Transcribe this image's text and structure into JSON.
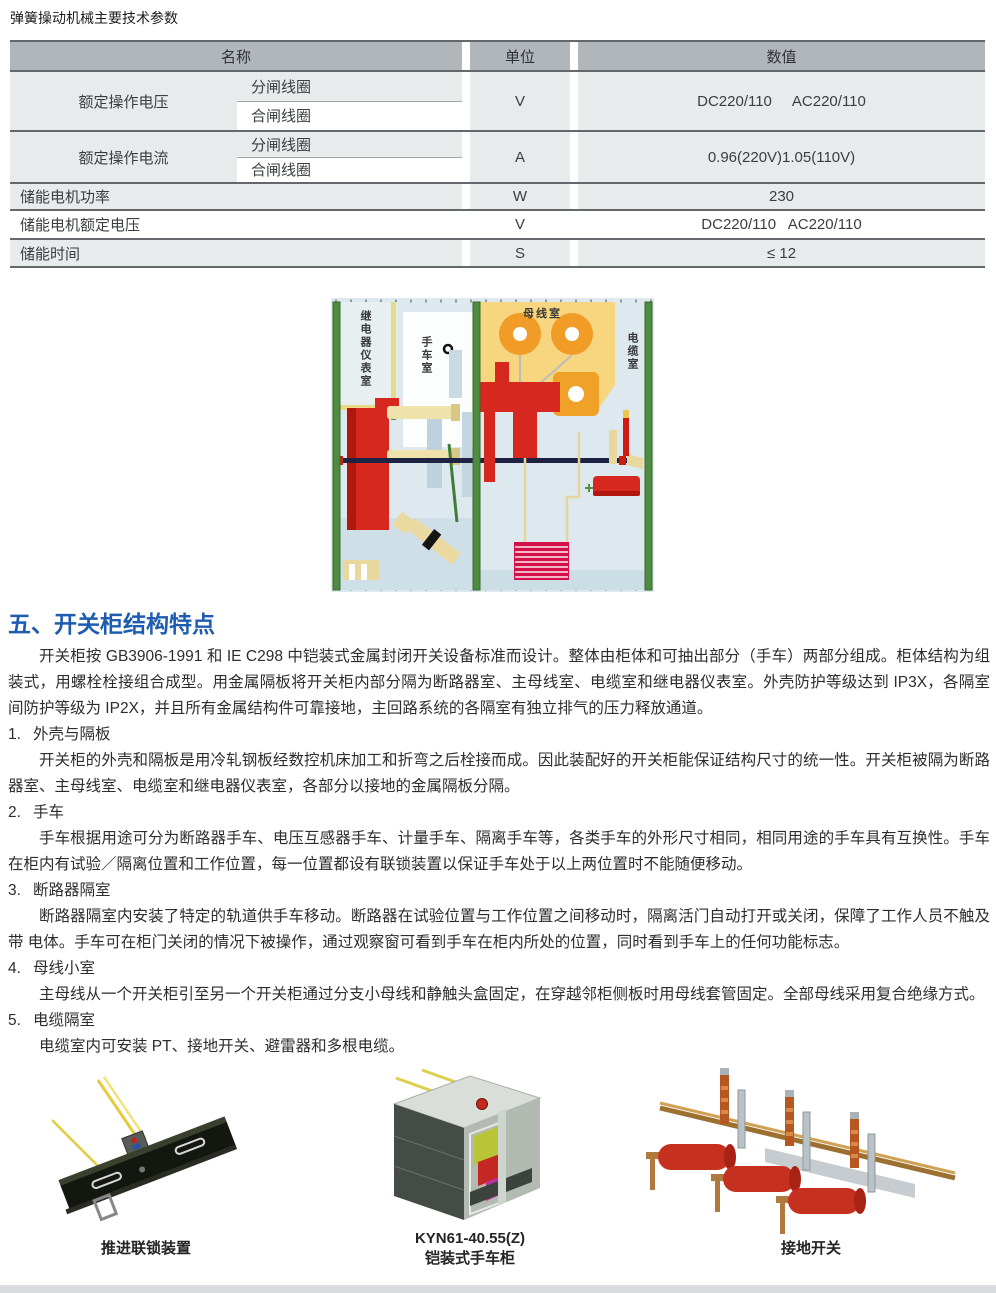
{
  "page": {
    "title": "弹簧操动机械主要技术参数"
  },
  "table": {
    "headers": {
      "name": "名称",
      "unit": "单位",
      "value": "数值"
    },
    "compound_rows": [
      {
        "name": "额定操作电压",
        "sub1": "分闸线圈",
        "sub2": "合闸线圈",
        "unit": "V",
        "value": "DC220/110     AC220/110"
      },
      {
        "name": "额定操作电流",
        "sub1": "分闸线圈",
        "sub2": "合闸线圈",
        "unit": "A",
        "value": "0.96(220V)1.05(110V)"
      }
    ],
    "simple_rows": [
      {
        "name": "储能电机功率",
        "unit": "W",
        "value": "230"
      },
      {
        "name": "储能电机额定电压",
        "unit": "V",
        "value": "DC220/110   AC220/110"
      },
      {
        "name": "储能时间",
        "unit": "S",
        "value": "≤ 12"
      }
    ]
  },
  "diagram": {
    "labels": {
      "relay_room": "继电器仪表室",
      "handcart_room": "手车室",
      "busbar_room": "母线室",
      "cable_room": "电缆室"
    }
  },
  "section": {
    "heading": "五、开关柜结构特点",
    "intro": "开关柜按 GB3906-1991 和 IE C298 中铠装式金属封闭开关设备标准而设计。整体由柜体和可抽出部分（手车）两部分组成。柜体结构为组装式，用螺栓栓接组合成型。用金属隔板将开关柜内部分隔为断路器室、主母线室、电缆室和继电器仪表室。外壳防护等级达到 IP3X，各隔室间防护等级为 IP2X，并且所有金属结构件可靠接地，主回路系统的各隔室有独立排气的压力释放通道。",
    "items": [
      {
        "num": "1.",
        "title": "外壳与隔板",
        "body": "开关柜的外壳和隔板是用冷轧钢板经数控机床加工和折弯之后栓接而成。因此装配好的开关柜能保证结构尺寸的统一性。开关柜被隔为断路 器室、主母线室、电缆室和继电器仪表室，各部分以接地的金属隔板分隔。"
      },
      {
        "num": "2.",
        "title": "手车",
        "body": "手车根据用途可分为断路器手车、电压互感器手车、计量手车、隔离手车等，各类手车的外形尺寸相同，相同用途的手车具有互换性。手车在柜内有试验／隔离位置和工作位置，每一位置都设有联锁装置以保证手车处于以上两位置时不能随便移动。"
      },
      {
        "num": "3.",
        "title": "断路器隔室",
        "body": "断路器隔室内安装了特定的轨道供手车移动。断路器在试验位置与工作位置之间移动时，隔离活门自动打开或关闭，保障了工作人员不触及带 电体。手车可在柜门关闭的情况下被操作，通过观察窗可看到手车在柜内所处的位置，同时看到手车上的任何功能标志。"
      },
      {
        "num": "4.",
        "title": "母线小室",
        "body": "主母线从一个开关柜引至另一个开关柜通过分支小母线和静触头盒固定，在穿越邻柜侧板时用母线套管固定。全部母线采用复合绝缘方式。"
      },
      {
        "num": "5.",
        "title": "电缆隔室",
        "body": "电缆室内可安装 PT、接地开关、避雷器和多根电缆。"
      }
    ]
  },
  "figures": [
    {
      "caption": "推进联锁装置"
    },
    {
      "caption": "KYN61-40.55(Z)",
      "caption2": "铠装式手车柜"
    },
    {
      "caption": "接地开关"
    }
  ],
  "colors": {
    "accent_blue": "#1d5cb0",
    "table_header_gray": "#b1b6ba",
    "table_row_gray": "#e8ebec",
    "diagram_background": "#dde9ee",
    "diagram_green": "#4f8c41",
    "diagram_orange": "#f09c26",
    "diagram_yellow": "#f8d67f",
    "diagram_red": "#d6281e",
    "diagram_navy": "#1e2343",
    "stack_crimson": "#d31047"
  }
}
